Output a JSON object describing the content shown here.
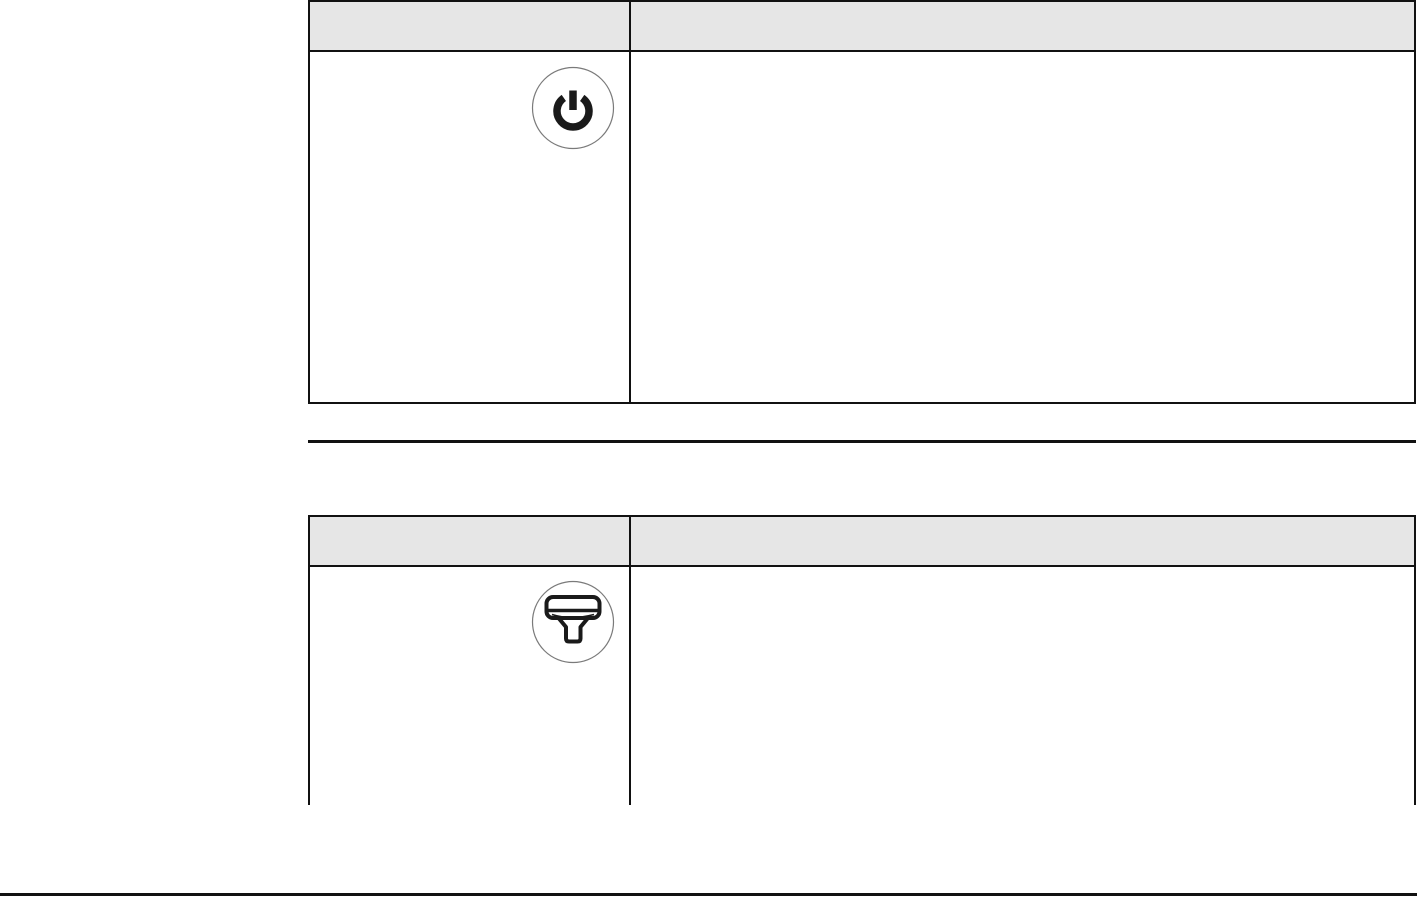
{
  "colors": {
    "header_bg": "#e6e6e6",
    "border": "#111111",
    "icon_stroke": "#1a1a1a",
    "circle_stroke": "#7a7a7a",
    "page_bg": "#ffffff"
  },
  "tables": [
    {
      "name": "power-button-table",
      "header": {
        "col1": "",
        "col2": ""
      },
      "rows": [
        {
          "icon": "power-icon",
          "description": ""
        }
      ]
    },
    {
      "name": "scanner-table",
      "header": {
        "col1": "",
        "col2": ""
      },
      "rows": [
        {
          "icon": "barcode-scanner-icon",
          "description": ""
        }
      ]
    }
  ]
}
